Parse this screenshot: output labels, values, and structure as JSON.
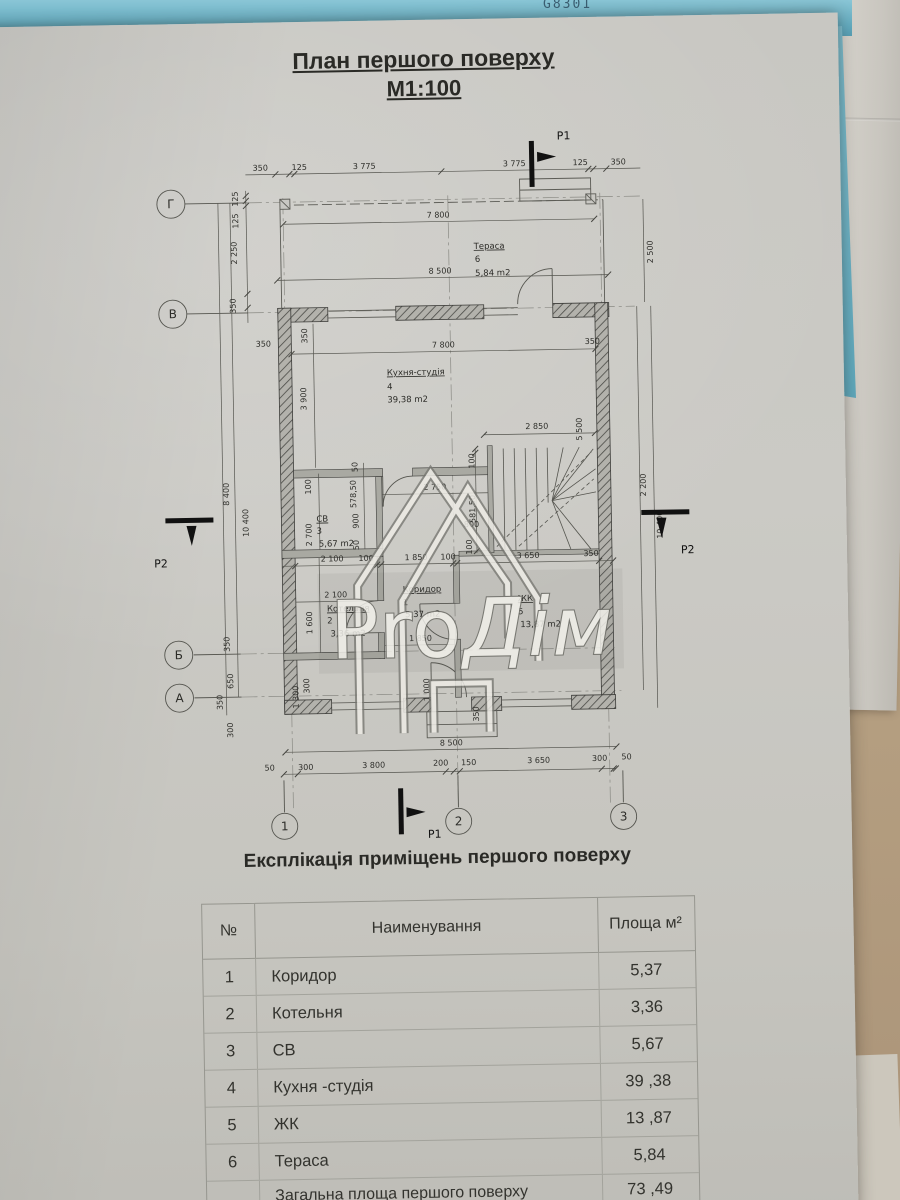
{
  "photo": {
    "strip_label": "G8301"
  },
  "title": {
    "line1": "План першого поверху",
    "line2": "М1:100"
  },
  "watermark": {
    "part1": "Pro",
    "part2": "Дім"
  },
  "plan": {
    "axes": {
      "g": "Г",
      "v": "В",
      "b": "Б",
      "a": "А",
      "n1": "1",
      "n2": "2",
      "n3": "3"
    },
    "sections": {
      "p1": "P1",
      "p2": "P2"
    },
    "rooms": {
      "terrace": {
        "name": "Тераса",
        "num": "6",
        "area": "5,84 m2"
      },
      "kitchen": {
        "name": "Кухня-студія",
        "num": "4",
        "area": "39,38 m2"
      },
      "sv": {
        "name": "СВ",
        "num": "3",
        "area": "5,67 m2"
      },
      "boiler": {
        "name": "Котельня",
        "num": "2",
        "area": "3,36 m2"
      },
      "corridor": {
        "name": "Коридор",
        "num": "1",
        "area": "5,37 m2"
      },
      "zhk": {
        "name": "ЖК",
        "num": "5",
        "area": "13,87 m2"
      }
    },
    "dims": {
      "top": [
        "350",
        "125",
        "3 775",
        "3 775",
        "125",
        "350"
      ],
      "top_width": "7 800",
      "terrace_width": "8 500",
      "left125a": "125",
      "left125b": "125",
      "left2250": "2 250",
      "left350": "350",
      "right2500": "2 500",
      "kitchen_width": "7 800",
      "k350r": "350",
      "k350l": "350",
      "k350wall": "350",
      "k3900": "3 900",
      "s2850": "2 850",
      "s5500": "5 500",
      "s100a": "100",
      "s58150": "581,50",
      "s800": "800",
      "s100b": "100",
      "sv2750": "2 750",
      "sv50a": "50",
      "sv57850": "578,50",
      "sv900": "900",
      "sv50b": "50",
      "sv100": "100",
      "sv2700": "2 700",
      "mid2100": "2 100",
      "mid100a": "100",
      "mid1850": "1 850",
      "mid100b": "100",
      "mid3650": "3 650",
      "mid350": "350",
      "b2100": "2 100",
      "b1600": "1 600",
      "c1850": "1 850",
      "lo8400": "8 400",
      "lo10400": "10 400",
      "ro2200": "2 200",
      "ro10400": "10 400",
      "lb350a": "350",
      "lb650": "650",
      "lb350b": "350",
      "lb300": "300",
      "bi1300": "1 300",
      "bi300": "300",
      "bi1000": "1 000",
      "bi350": "350",
      "bottom_width": "8 500",
      "bottom": [
        "50",
        "300",
        "3 800",
        "200",
        "150",
        "3 650",
        "300",
        "50"
      ]
    }
  },
  "table": {
    "heading": "Експлікація приміщень першого поверху",
    "headers": {
      "num": "№",
      "name": "Наименування",
      "area": "Площа м²"
    },
    "rows": [
      {
        "num": "1",
        "name": "Коридор",
        "area": "5,37"
      },
      {
        "num": "2",
        "name": "Котельня",
        "area": "3,36"
      },
      {
        "num": "3",
        "name": "СВ",
        "area": "5,67"
      },
      {
        "num": "4",
        "name": "Кухня  -студія",
        "area": "39 ,38"
      },
      {
        "num": "5",
        "name": "ЖК",
        "area": "13 ,87"
      },
      {
        "num": "6",
        "name": "Тераса",
        "area": "5,84"
      }
    ],
    "total": {
      "name": "Загальна площа першого поверху",
      "area": "73 ,49"
    }
  }
}
